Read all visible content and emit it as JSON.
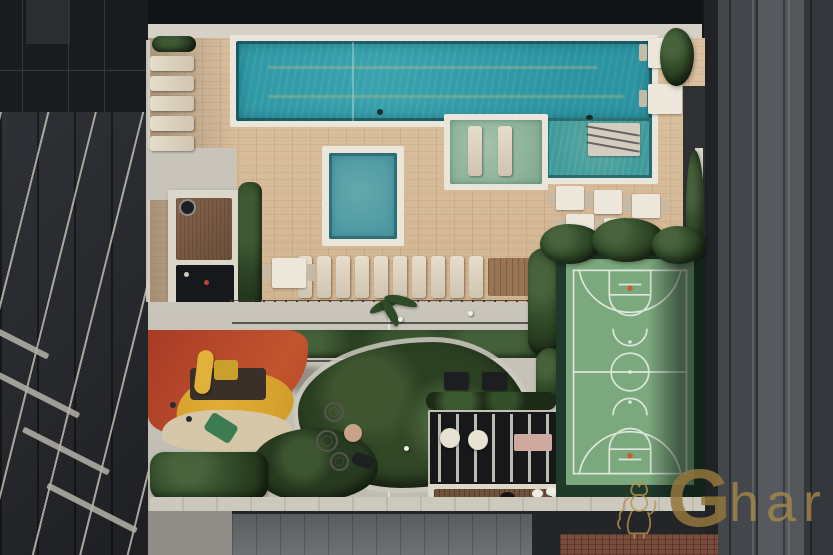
{
  "meta": {
    "type": "aerial-photograph",
    "subject": "rooftop amenity deck of a residential complex: lap pool, kids pool, wet deck, sun loungers, dining tables, barbecue pergola, playground, landscaped garden and multi-sport court between two dark tower facades"
  },
  "watermark": {
    "brand": "Ghar",
    "brand_initial": "G",
    "brand_rest": "har",
    "color": "#a8894a"
  },
  "palette": {
    "deck_wood": "#d7bd9c",
    "pool_water": "#2f9aa6",
    "pool_shelf": "#4fa39b",
    "wet_deck_tile": "#94b8a5",
    "kids_pool": "#57a0a6",
    "pool_frame": "#eae6dc",
    "concrete": "#c9c5bb",
    "court_green": "#7ca87e",
    "court_lines": "#e2ebdf",
    "court_surround": "#1f3a2b",
    "play_red": "#b5452a",
    "play_yellow": "#dca52f",
    "foliage": "#2d4227",
    "facade_left": "#26282c",
    "facade_right": "#43464b",
    "roof_dark": "#191b1e",
    "ground": "#232528",
    "brick": "#7a4c3b"
  },
  "scene_regions": [
    "left-tower-balconies",
    "left-tower-roof",
    "right-tower-facade",
    "lap-pool",
    "pool-shallow-shelf",
    "pool-steps",
    "wet-deck",
    "kids-pool",
    "sun-lounger-column",
    "sun-lounger-row",
    "dining-tables",
    "barbecue-pergola",
    "playground",
    "garden-bed",
    "gourmet-pergola",
    "sports-court",
    "ground-level-roof",
    "watermark"
  ]
}
